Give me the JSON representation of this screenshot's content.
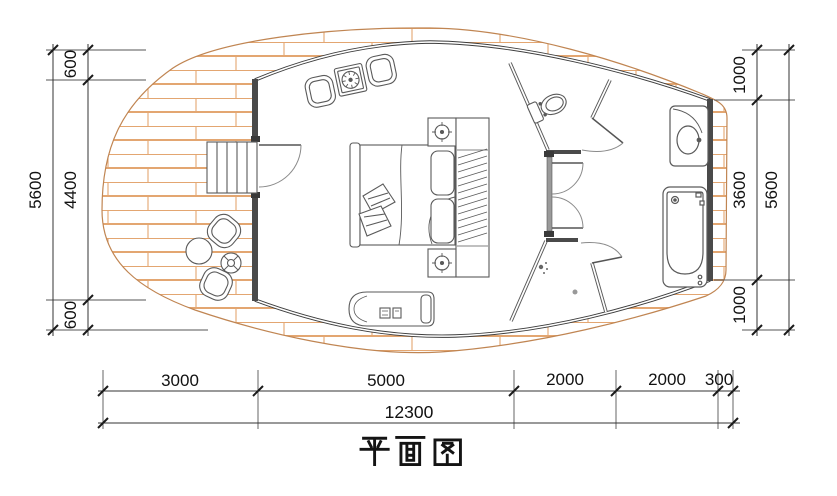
{
  "title": "平面图",
  "drawing_type": "architectural floor plan of oval cabin with deck",
  "dims": {
    "left_outer_total": "5600",
    "left_segments": [
      "600",
      "4400",
      "600"
    ],
    "right_segments": [
      "1000",
      "3600",
      "1000"
    ],
    "right_outer_total": "5600",
    "bottom_segments": [
      "3000",
      "5000",
      "2000",
      "2000",
      "300"
    ],
    "bottom_outer_total": "12300"
  },
  "colors": {
    "deck_hatch": "#e3a671",
    "deck_outline": "#c08552",
    "wall_dark": "#4a4a4a",
    "partition_gray": "#9a9a9a",
    "line_dark": "#3d3d3d",
    "dim_text": "#111111"
  },
  "symbols": [
    "entry-stairs",
    "entry-door",
    "patio-armchairs",
    "patio-table",
    "deck-armchairs",
    "deck-round-table",
    "deck-side-table",
    "double-bed",
    "cushions",
    "nightstand-lamps",
    "wardrobe",
    "chaise-lounge",
    "toilet",
    "toilet-door",
    "shower",
    "shower-door",
    "corridor-doors",
    "washbasin-vanity",
    "bathtub"
  ]
}
